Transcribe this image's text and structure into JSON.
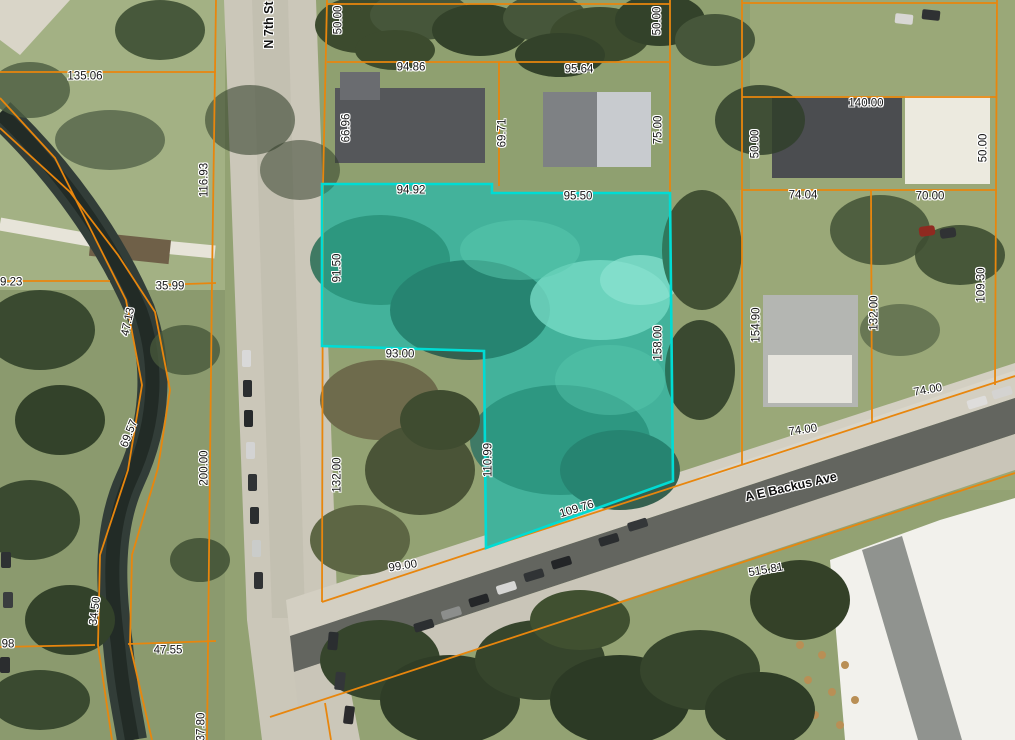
{
  "map": {
    "colors": {
      "parcel_line": "#E8860D",
      "highlight_stroke": "#00DCD4",
      "highlight_fill": "rgba(0,225,200,0.28)",
      "label_text": "#151515"
    },
    "streets": [
      {
        "name": "N 7th St",
        "x": 269,
        "y": 25,
        "rot": -90
      },
      {
        "name": "A E Backus Ave",
        "x": 791,
        "y": 487,
        "rot": -13
      }
    ],
    "dimension_labels": [
      {
        "text": "135.06",
        "x": 85,
        "y": 77,
        "rot": 0
      },
      {
        "text": "116.93",
        "x": 205,
        "y": 180,
        "rot": -90
      },
      {
        "text": "50.00",
        "x": 339,
        "y": 20,
        "rot": -90
      },
      {
        "text": "94.86",
        "x": 411,
        "y": 68,
        "rot": 0
      },
      {
        "text": "66.96",
        "x": 347,
        "y": 128,
        "rot": -90
      },
      {
        "text": "69.71",
        "x": 503,
        "y": 133,
        "rot": -90
      },
      {
        "text": "95.64",
        "x": 579,
        "y": 70,
        "rot": 0
      },
      {
        "text": "50.00",
        "x": 658,
        "y": 21,
        "rot": -90
      },
      {
        "text": "75.00",
        "x": 659,
        "y": 130,
        "rot": -90
      },
      {
        "text": "140.00",
        "x": 866,
        "y": 104,
        "rot": 0
      },
      {
        "text": "50.00",
        "x": 756,
        "y": 144,
        "rot": -90
      },
      {
        "text": "50.00",
        "x": 984,
        "y": 148,
        "rot": -90
      },
      {
        "text": "74.04",
        "x": 803,
        "y": 196,
        "rot": 0
      },
      {
        "text": "70.00",
        "x": 930,
        "y": 197,
        "rot": 0
      },
      {
        "text": "94.92",
        "x": 411,
        "y": 191,
        "rot": 0
      },
      {
        "text": "95.50",
        "x": 578,
        "y": 197,
        "rot": 0
      },
      {
        "text": "91.50",
        "x": 338,
        "y": 268,
        "rot": -90
      },
      {
        "text": "93.00",
        "x": 400,
        "y": 355,
        "rot": 0
      },
      {
        "text": "158.00",
        "x": 659,
        "y": 343,
        "rot": -90
      },
      {
        "text": "29.23",
        "x": 8,
        "y": 283,
        "rot": 0
      },
      {
        "text": "35.99",
        "x": 170,
        "y": 287,
        "rot": 0
      },
      {
        "text": "47.13",
        "x": 129,
        "y": 322,
        "rot": -78
      },
      {
        "text": "69.57",
        "x": 130,
        "y": 434,
        "rot": -68
      },
      {
        "text": "200.00",
        "x": 205,
        "y": 468,
        "rot": -90
      },
      {
        "text": "132.00",
        "x": 338,
        "y": 475,
        "rot": -90
      },
      {
        "text": "110.99",
        "x": 489,
        "y": 460,
        "rot": -90
      },
      {
        "text": "109.76",
        "x": 577,
        "y": 510,
        "rot": -17
      },
      {
        "text": "154.90",
        "x": 757,
        "y": 325,
        "rot": -90
      },
      {
        "text": "132.00",
        "x": 875,
        "y": 313,
        "rot": -90
      },
      {
        "text": "109.30",
        "x": 982,
        "y": 285,
        "rot": -90
      },
      {
        "text": "74.00",
        "x": 928,
        "y": 391,
        "rot": -10
      },
      {
        "text": "74.00",
        "x": 803,
        "y": 431,
        "rot": -8
      },
      {
        "text": "34.50",
        "x": 96,
        "y": 611,
        "rot": -83
      },
      {
        "text": "47.55",
        "x": 168,
        "y": 651,
        "rot": 0
      },
      {
        "text": "98",
        "x": 8,
        "y": 645,
        "rot": 0
      },
      {
        "text": "99.00",
        "x": 403,
        "y": 567,
        "rot": -9
      },
      {
        "text": "515.81",
        "x": 766,
        "y": 571,
        "rot": -10
      },
      {
        "text": "37.80",
        "x": 202,
        "y": 727,
        "rot": -90
      }
    ],
    "highlighted_parcel": {
      "points": [
        [
          322,
          184
        ],
        [
          492,
          184
        ],
        [
          492,
          193
        ],
        [
          670,
          193
        ],
        [
          673,
          481
        ],
        [
          486,
          548
        ],
        [
          484,
          351
        ],
        [
          322,
          346
        ]
      ]
    },
    "parcel_lines": {
      "polylines": [
        [
          [
            327,
            0
          ],
          [
            323,
            185
          ],
          [
            322,
            602
          ]
        ],
        [
          [
            216,
            0
          ],
          [
            212,
            281
          ],
          [
            207,
            740
          ]
        ],
        [
          [
            0,
            281
          ],
          [
            110,
            281
          ]
        ],
        [
          [
            158,
            285
          ],
          [
            216,
            283
          ]
        ],
        [
          [
            0,
            72
          ],
          [
            216,
            72
          ]
        ],
        [
          [
            327,
            4
          ],
          [
            670,
            4
          ]
        ],
        [
          [
            327,
            62
          ],
          [
            670,
            62
          ]
        ],
        [
          [
            499,
            62
          ],
          [
            499,
            186
          ]
        ],
        [
          [
            670,
            0
          ],
          [
            670,
            193
          ]
        ],
        [
          [
            742,
            0
          ],
          [
            742,
            464
          ]
        ],
        [
          [
            997,
            0
          ],
          [
            995,
            385
          ]
        ],
        [
          [
            742,
            3
          ],
          [
            997,
            3
          ]
        ],
        [
          [
            742,
            97
          ],
          [
            997,
            97
          ]
        ],
        [
          [
            742,
            190
          ],
          [
            997,
            190
          ]
        ],
        [
          [
            871,
            190
          ],
          [
            872,
            423
          ]
        ],
        [
          [
            486,
            548
          ],
          [
            1015,
            376
          ]
        ],
        [
          [
            270,
            717
          ],
          [
            1015,
            473
          ]
        ],
        [
          [
            325,
            703
          ],
          [
            331,
            740
          ]
        ],
        [
          [
            322,
            602
          ],
          [
            486,
            548
          ]
        ],
        [
          [
            128,
            644
          ],
          [
            216,
            641
          ]
        ],
        [
          [
            0,
            647
          ],
          [
            95,
            645
          ]
        ],
        [
          [
            0,
            98
          ],
          [
            55,
            158
          ],
          [
            90,
            228
          ],
          [
            126,
            300
          ],
          [
            142,
            385
          ],
          [
            128,
            470
          ],
          [
            100,
            555
          ],
          [
            98,
            645
          ],
          [
            112,
            740
          ]
        ],
        [
          [
            0,
            128
          ],
          [
            70,
            192
          ],
          [
            118,
            255
          ],
          [
            155,
            312
          ],
          [
            170,
            390
          ],
          [
            158,
            468
          ],
          [
            132,
            555
          ],
          [
            130,
            645
          ],
          [
            152,
            740
          ]
        ]
      ]
    }
  }
}
